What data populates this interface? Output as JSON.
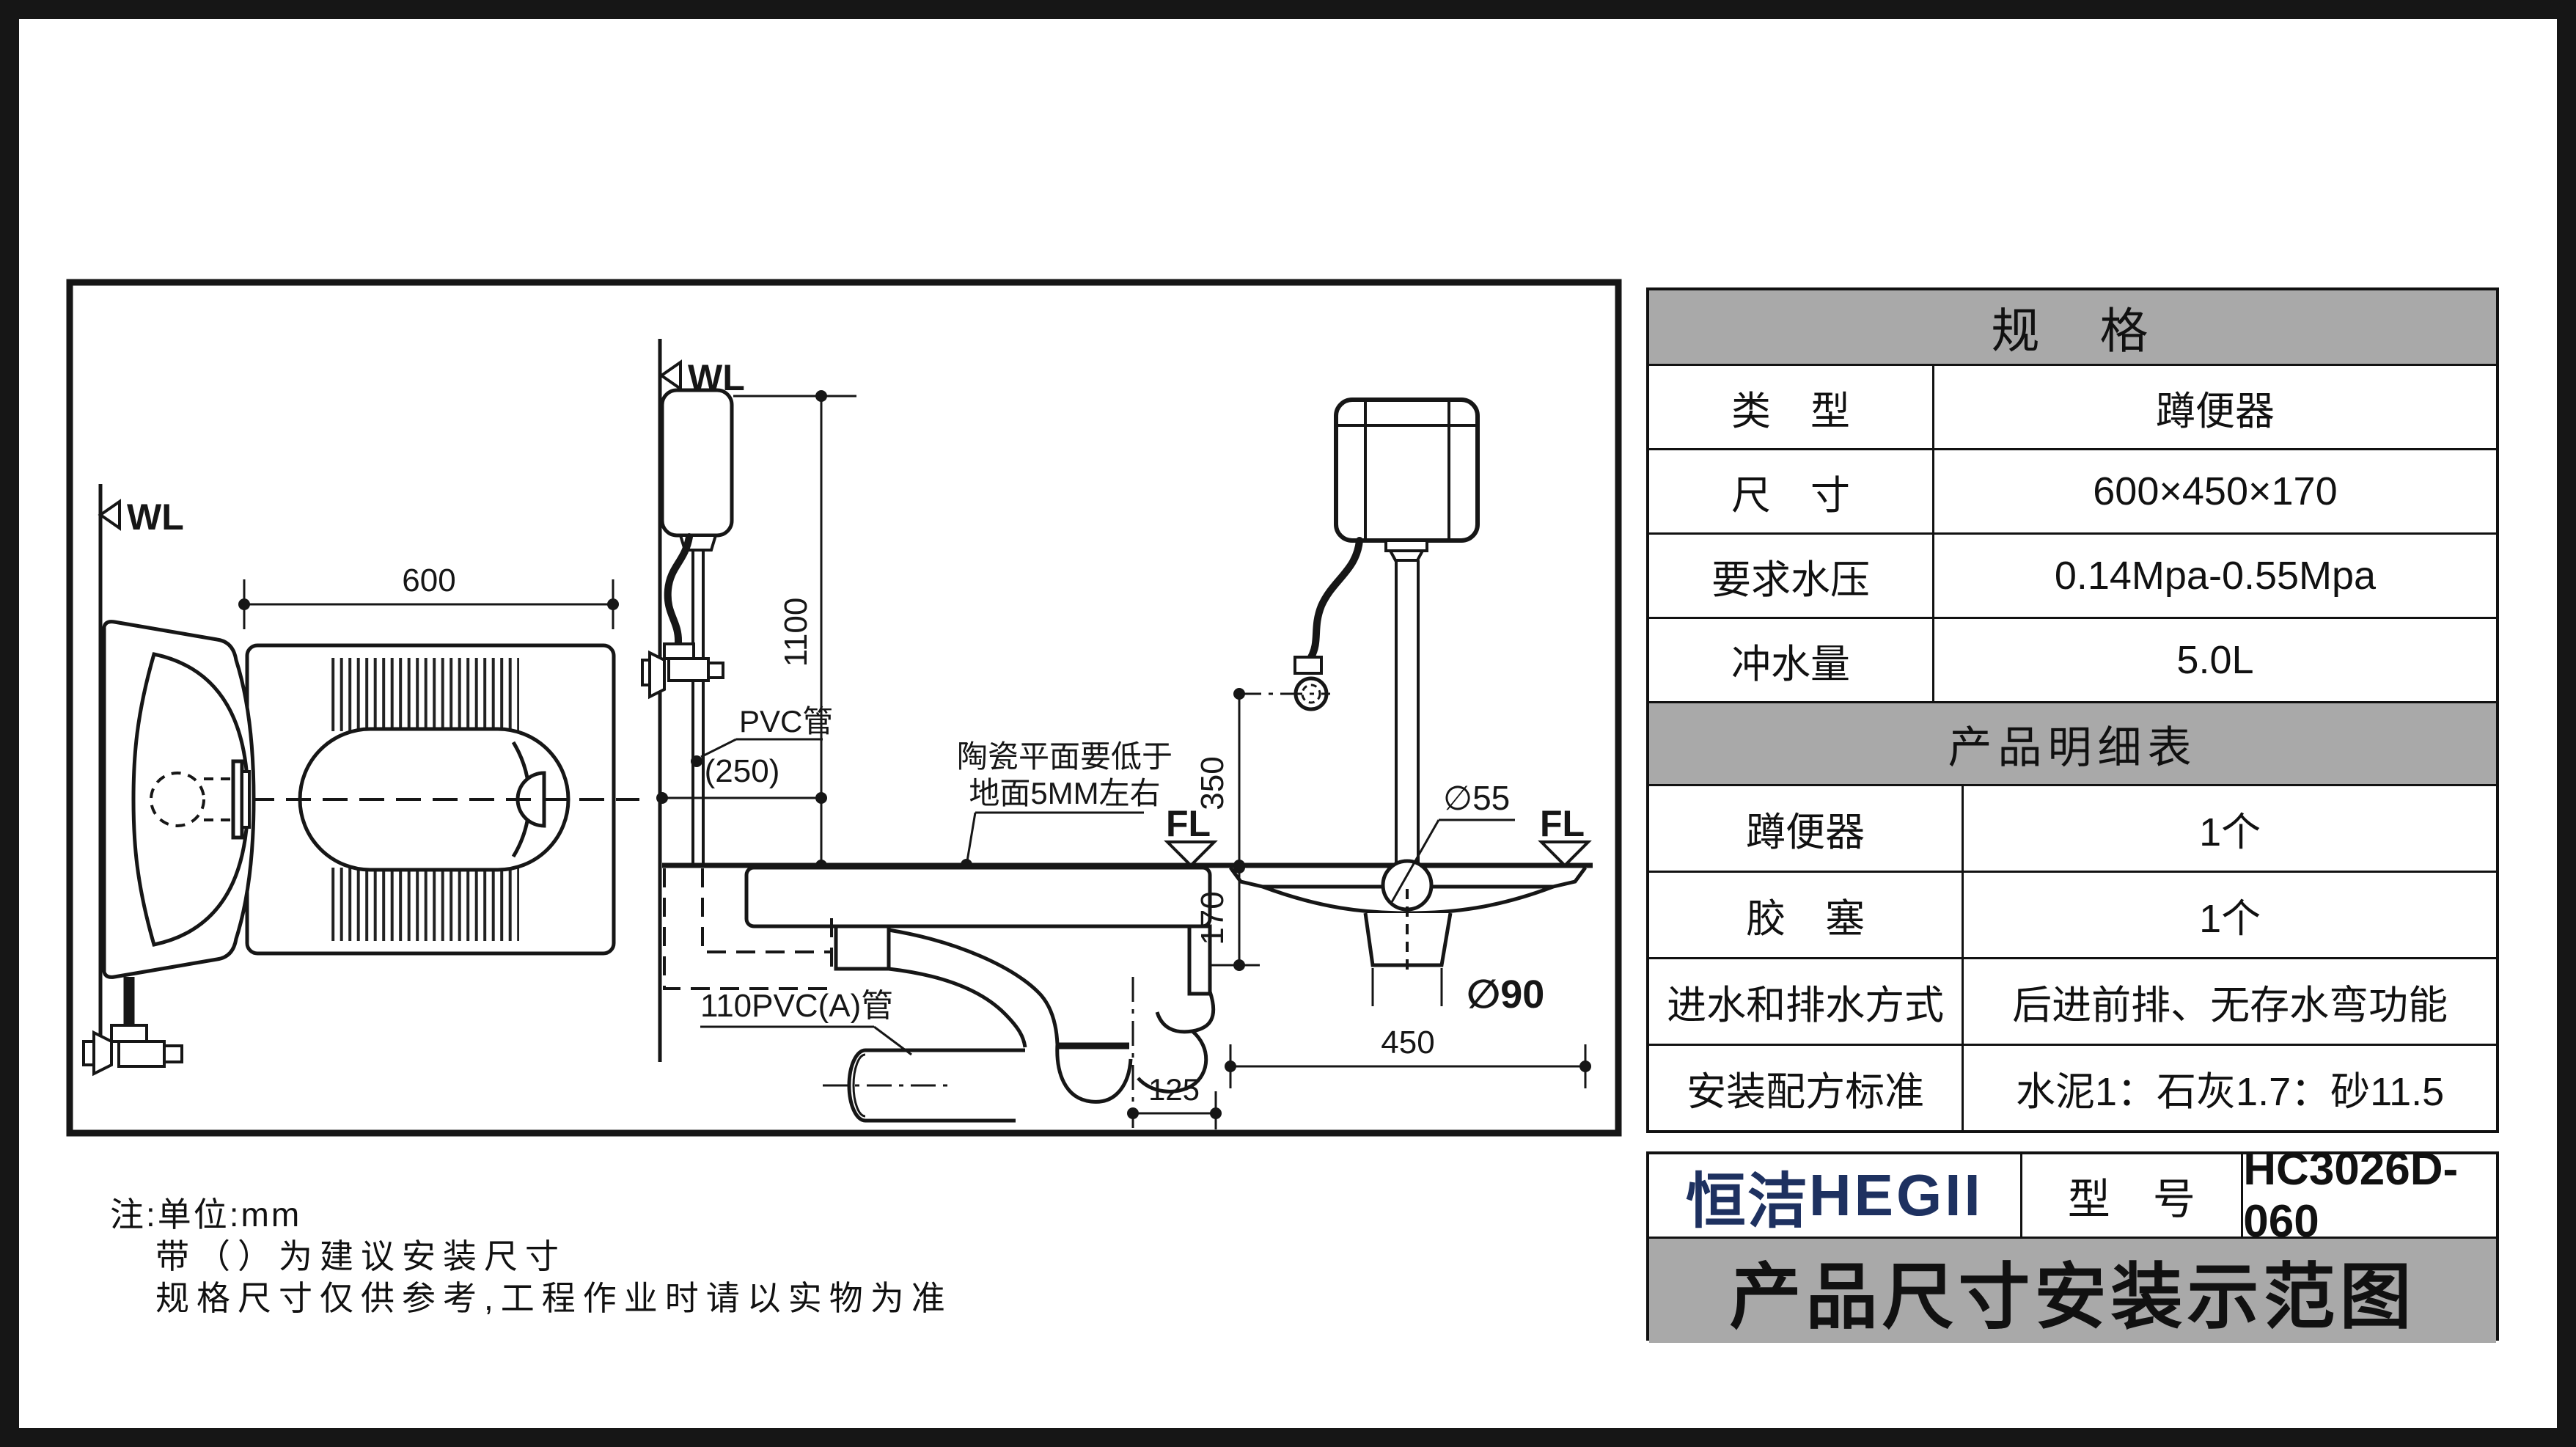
{
  "colors": {
    "line": "#161616",
    "table_header_bg": "#a9a9a9",
    "title_bar_bg": "#a9a9a9",
    "brand_blue": "#1e3160",
    "background": "#ffffff"
  },
  "spec_table": {
    "title": "规　格",
    "rows": [
      {
        "label": "类　型",
        "value": "蹲便器"
      },
      {
        "label": "尺　寸",
        "value": "600×450×170"
      },
      {
        "label": "要求水压",
        "value": "0.14Mpa-0.55Mpa"
      },
      {
        "label": "冲水量",
        "value": "5.0L"
      }
    ]
  },
  "detail_table": {
    "title": "产品明细表",
    "rows": [
      {
        "label": "蹲便器",
        "value": "1个"
      },
      {
        "label": "胶　塞",
        "value": "1个"
      },
      {
        "label": "进水和排水方式",
        "value": "后进前排、无存水弯功能"
      },
      {
        "label": "安装配方标准",
        "value": "水泥1：石灰1.7：砂11.5"
      }
    ]
  },
  "title_block": {
    "brand_cn": "恒洁",
    "brand_en": "HEGII",
    "model_label": "型　号",
    "model_value": "HC3026D-060",
    "sheet_title": "产品尺寸安装示范图"
  },
  "notes": {
    "line1": "注:单位:mm",
    "line2": "带（）为建议安装尺寸",
    "line3": "规格尺寸仅供参考,工程作业时请以实物为准"
  },
  "drawing": {
    "plan": {
      "wall_label": "WL",
      "dim_width": "600"
    },
    "side": {
      "wall_label": "WL",
      "floor_label": "FL",
      "dim_height": "1100",
      "dim_wall_offset": "(250)",
      "label_flush_pipe": "PVC管",
      "note_surface_line1": "陶瓷平面要低于",
      "note_surface_line2": "地面5MM左右",
      "label_drain_pipe": "110PVC(A)管",
      "dim_trap_offset": "125"
    },
    "front": {
      "floor_label": "FL",
      "dim_valve_height": "350",
      "dim_depth": "170",
      "dim_inlet_dia": "∅55",
      "dim_outlet_dia": "∅90",
      "dim_width": "450"
    }
  }
}
